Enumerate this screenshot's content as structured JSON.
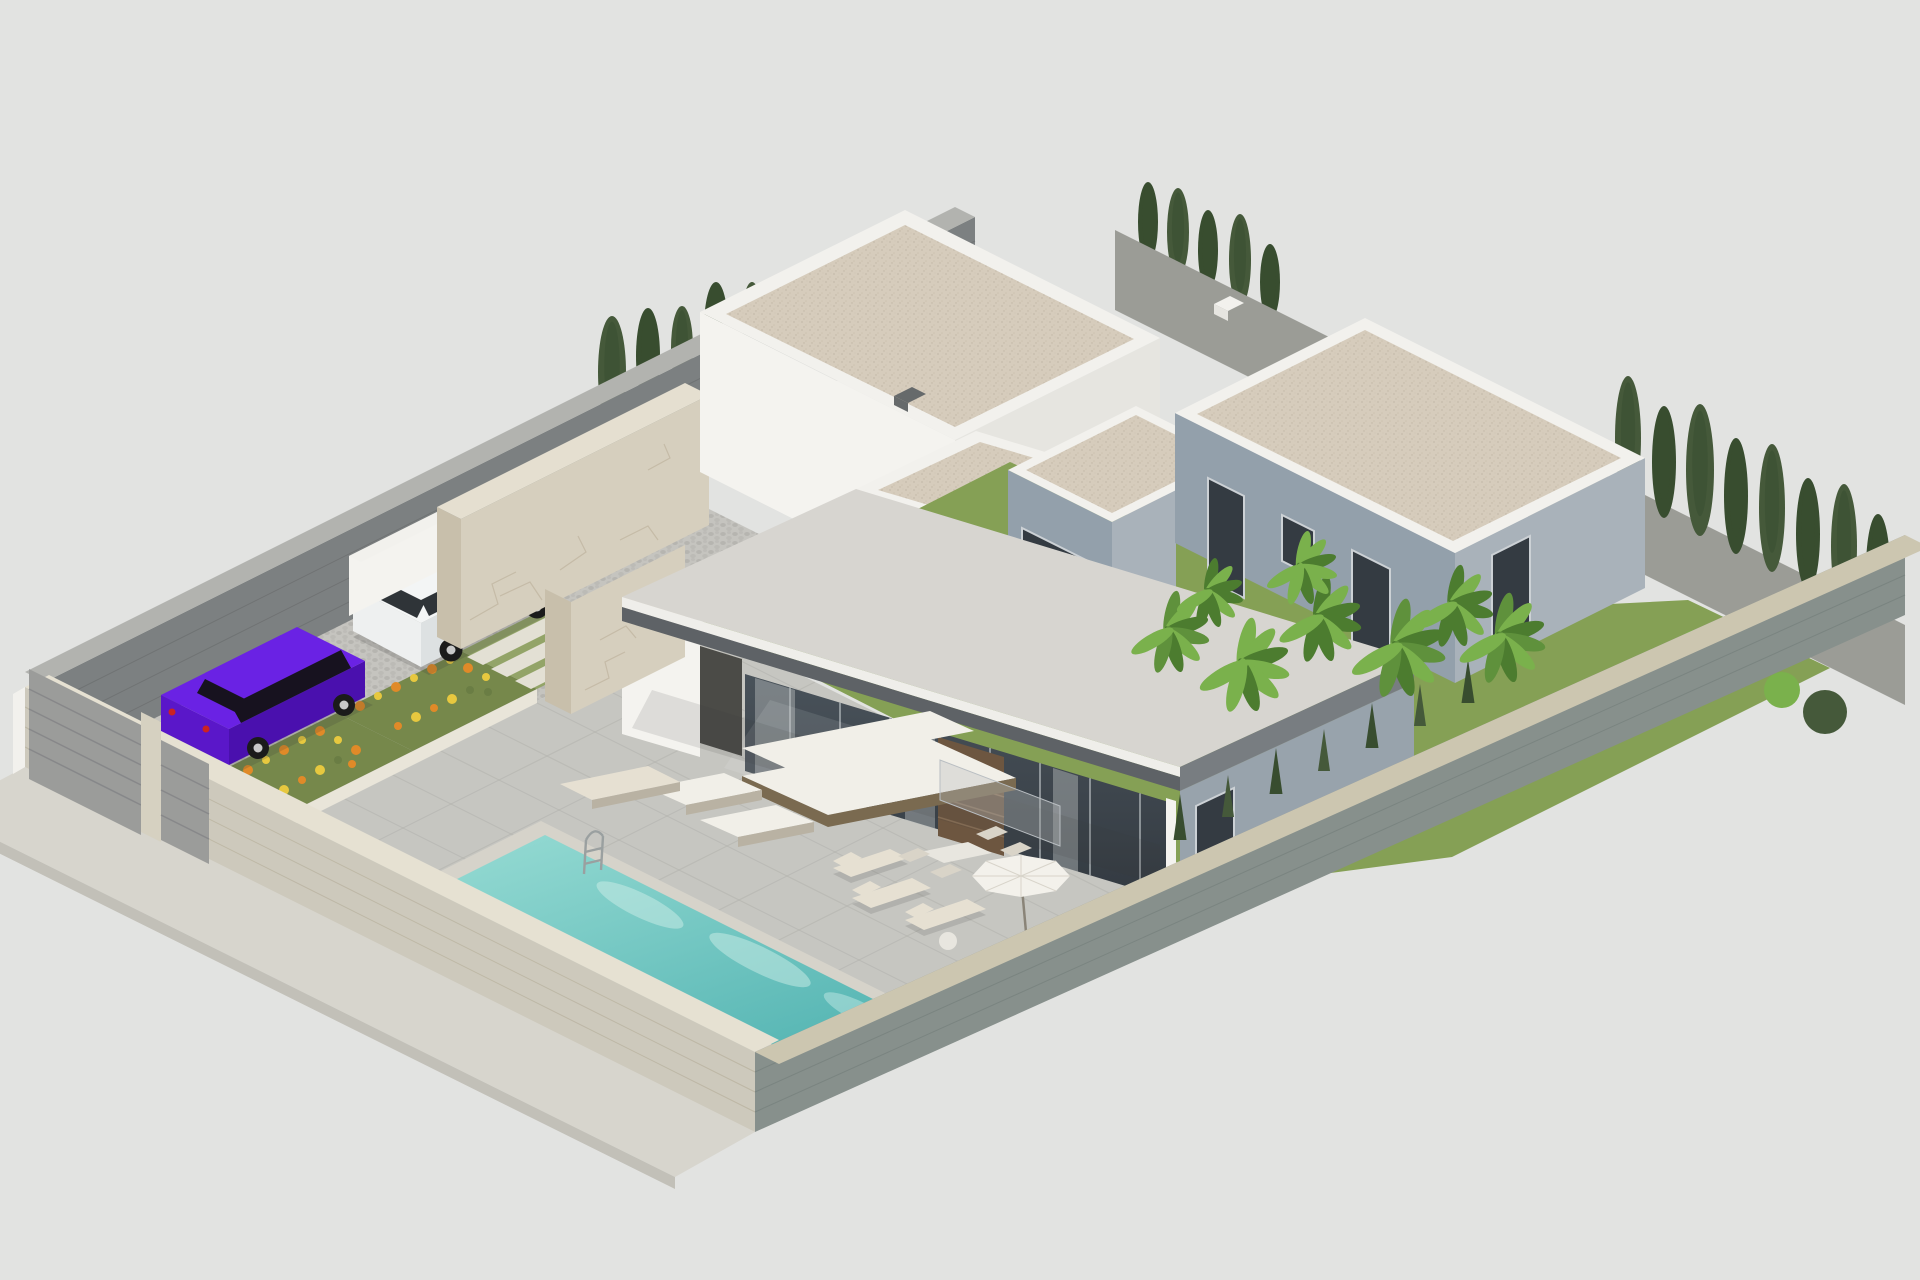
{
  "scene": {
    "description": "Isometric 3D render of a modern flat-roof villa plot: walled parcel with driveway gates, two parked cars, stone feature walls, covered terrace with furniture, swimming pool, gravel roofs, neighbouring grey villa and tropical garden",
    "background": "#e2e3e1",
    "objects": [
      {
        "name": "sidewalk",
        "label": "pavement outside plot"
      },
      {
        "name": "front-wall",
        "label": "front boundary wall"
      },
      {
        "name": "driveway-gate",
        "label": "grey sliding gate"
      },
      {
        "name": "pedestrian-gate",
        "label": "small grey gate"
      },
      {
        "name": "back-wall",
        "label": "rear-left boundary wall"
      },
      {
        "name": "right-wall",
        "label": "right boundary wall"
      },
      {
        "name": "se-wall",
        "label": "lower-right boundary wall"
      },
      {
        "name": "driveway",
        "label": "cobbled carport"
      },
      {
        "name": "purple-sedan",
        "label": "purple car"
      },
      {
        "name": "white-suv",
        "label": "white SUV"
      },
      {
        "name": "flower-planters",
        "label": "planters with orange flowers"
      },
      {
        "name": "garden-steps",
        "label": "grass steps"
      },
      {
        "name": "terrace",
        "label": "paved pool terrace"
      },
      {
        "name": "swimming-pool",
        "label": "turquoise pool with ladder"
      },
      {
        "name": "stone-walls",
        "label": "travertine clad feature walls"
      },
      {
        "name": "rear-annex",
        "label": "rear white building"
      },
      {
        "name": "main-villa",
        "label": "main villa with cantilever roof and glass facade"
      },
      {
        "name": "neighbor-villa",
        "label": "grey neighbouring villa"
      },
      {
        "name": "outdoor-sofa",
        "label": "white outdoor sofa set"
      },
      {
        "name": "sun-loungers",
        "label": "three sun loungers"
      },
      {
        "name": "parasol",
        "label": "white parasol"
      },
      {
        "name": "dining-set",
        "label": "outdoor dining table"
      },
      {
        "name": "banana-plants",
        "label": "tropical plants"
      },
      {
        "name": "cypress-trees",
        "label": "cypress rows"
      },
      {
        "name": "lawn",
        "label": "garden grass"
      }
    ],
    "palette": {
      "bg": "#e2e3e1",
      "sidewalk": "#d7d5cd",
      "sidewalkEdge": "#c2c0b8",
      "frontWall": "#cdc9bc",
      "frontWallLine": "#bdb7a5",
      "frontWallTop": "#e6e1d2",
      "backWall": "#7c8081",
      "backWallLine": "#6f7273",
      "backWallTop": "#b2b3af",
      "rightWall": "#9b9c96",
      "rightWallTop": "#c0bfb6",
      "seWall": "#87908c",
      "seWallLine": "#7a8480",
      "seWallTop": "#ccc6b0",
      "cobble": "url(#cobblePat)",
      "gravel": "url(#gravelPat)",
      "water": "url(#waterGrad)",
      "glass": "url(#glassGrad)",
      "terrace": "#c6c6c1",
      "terraceLine": "#b2b2ad",
      "poolCoping": "#d6d3ca",
      "caustic": "#cdeee8",
      "ladder": "#9aa0a0",
      "planterFace": "#e9e5d9",
      "planterFaceShade": "#d9d4c6",
      "planterSoil": "#76884b",
      "flowerOrange": "#e08a28",
      "flowerYellow": "#e7c83f",
      "flowerGreen": "#6a7d44",
      "stepGrass": "#93a468",
      "stepStone": "#e3e0d4",
      "stone": "#d6cfbe",
      "stoneShade": "#c8bfab",
      "stoneTop": "#e5dfd0",
      "stoneCrack": "#bdb29c",
      "doorDark": "#4b4b47",
      "ventDark": "#666a6b",
      "whiteBright": "#f4f3ef",
      "whiteShade": "#e6e5e0",
      "parapet": "#f2f1ed",
      "slabTop": "#d7d5d0",
      "slabRim": "#efeeea",
      "facia": "#5e6266",
      "faciaEdge": "#787d81",
      "mullion": "#b9bec2",
      "curtain": "#b9bcbd",
      "reflect": "#ffffff",
      "wood": "#6d5640",
      "woodLine": "#8b7157",
      "endWall": "#98a3ac",
      "bWall": "#93a0ab",
      "bWallLight": "#a9b2ba",
      "windowDark": "#343b42",
      "windowFrame": "#ccd1d5",
      "grass": "#85a055",
      "leafA": "#5f913c",
      "leafB": "#7ab14c",
      "leafC": "#4c7c2f",
      "cypressA": "#45593a",
      "cypressB": "#384d2f",
      "trunk": "#5d5a40",
      "purpleTop": "#6a22e4",
      "purpleSide": "#4a10ae",
      "purpleFront": "#5a17c9",
      "purpleGlass": "#17121f",
      "suvTop": "#f3f5f5",
      "suvSide": "#dde1e2",
      "suvFront": "#eef0f0",
      "suvGlass": "#2f3438",
      "wheel": "#1b1b1b",
      "hub": "#c9c9c9",
      "tailLight": "#cc2222",
      "gate": "#9b9c9a",
      "gateLine": "#87888a",
      "gatePost": "#d6d1c1",
      "sofaWhite": "#f1efe8",
      "sofaFrame": "#7a6a50",
      "loungerPad": "#e6e0d2",
      "loungerLeg": "#b9b2a3",
      "tableTop": "#e8e6df",
      "chair": "#d9d4c8",
      "umbrella": "#f3f1eb",
      "umbrellaSeam": "#d8d4ca",
      "pole": "#8a8478",
      "shadow": "#3a3a3a"
    }
  },
  "vegetation": {
    "back_cypresses": [
      {
        "cx": 612,
        "cy": 428,
        "rx": 14,
        "ry": 56,
        "c": "cypressA"
      },
      {
        "cx": 648,
        "cy": 404,
        "rx": 12,
        "ry": 48,
        "c": "cypressB"
      },
      {
        "cx": 682,
        "cy": 390,
        "rx": 11,
        "ry": 42,
        "c": "cypressA"
      },
      {
        "cx": 716,
        "cy": 374,
        "rx": 12,
        "ry": 46,
        "c": "cypressB"
      },
      {
        "cx": 752,
        "cy": 358,
        "rx": 10,
        "ry": 38,
        "c": "cypressA"
      }
    ],
    "ridge_cypresses": [
      {
        "cx": 1148,
        "cy": 262,
        "rx": 10,
        "ry": 40,
        "c": "cypressB"
      },
      {
        "cx": 1178,
        "cy": 276,
        "rx": 11,
        "ry": 44,
        "c": "cypressA"
      },
      {
        "cx": 1208,
        "cy": 290,
        "rx": 10,
        "ry": 40,
        "c": "cypressB"
      },
      {
        "cx": 1240,
        "cy": 306,
        "rx": 11,
        "ry": 46,
        "c": "cypressA"
      },
      {
        "cx": 1270,
        "cy": 320,
        "rx": 10,
        "ry": 38,
        "c": "cypressB"
      }
    ],
    "right_cypresses": [
      {
        "cx": 1628,
        "cy": 500,
        "rx": 13,
        "ry": 62,
        "c": "cypressA"
      },
      {
        "cx": 1664,
        "cy": 518,
        "rx": 12,
        "ry": 56,
        "c": "cypressB"
      },
      {
        "cx": 1700,
        "cy": 536,
        "rx": 14,
        "ry": 66,
        "c": "cypressA"
      },
      {
        "cx": 1736,
        "cy": 554,
        "rx": 12,
        "ry": 58,
        "c": "cypressB"
      },
      {
        "cx": 1772,
        "cy": 572,
        "rx": 13,
        "ry": 64,
        "c": "cypressA"
      },
      {
        "cx": 1808,
        "cy": 590,
        "rx": 12,
        "ry": 56,
        "c": "cypressB"
      },
      {
        "cx": 1844,
        "cy": 608,
        "rx": 13,
        "ry": 62,
        "c": "cypressA"
      },
      {
        "cx": 1878,
        "cy": 624,
        "rx": 12,
        "ry": 55,
        "c": "cypressB"
      }
    ],
    "se_cypresses": [
      {
        "cx": 1180,
        "cy": 840,
        "w": 13,
        "h": 46,
        "c": "cypressB"
      },
      {
        "cx": 1228,
        "cy": 817,
        "w": 12,
        "h": 42,
        "c": "cypressA"
      },
      {
        "cx": 1276,
        "cy": 794,
        "w": 13,
        "h": 46,
        "c": "cypressB"
      },
      {
        "cx": 1324,
        "cy": 771,
        "w": 12,
        "h": 42,
        "c": "cypressA"
      },
      {
        "cx": 1372,
        "cy": 748,
        "w": 13,
        "h": 45,
        "c": "cypressB"
      },
      {
        "cx": 1420,
        "cy": 726,
        "w": 12,
        "h": 42,
        "c": "cypressA"
      },
      {
        "cx": 1468,
        "cy": 703,
        "w": 13,
        "h": 44,
        "c": "cypressB"
      }
    ],
    "bushes": [
      {
        "cx": 1695,
        "cy": 646,
        "r": 16,
        "c": "leafB"
      },
      {
        "cx": 1738,
        "cy": 668,
        "r": 20,
        "c": "cypressA"
      },
      {
        "cx": 1782,
        "cy": 690,
        "r": 18,
        "c": "leafB"
      },
      {
        "cx": 1825,
        "cy": 712,
        "r": 22,
        "c": "cypressA"
      }
    ],
    "banana_plants": [
      {
        "cx": 1168,
        "cy": 652,
        "s": 1.0,
        "c": "leafA"
      },
      {
        "cx": 1242,
        "cy": 688,
        "s": 1.15,
        "c": "leafB"
      },
      {
        "cx": 1318,
        "cy": 640,
        "s": 1.05,
        "c": "leafC"
      },
      {
        "cx": 1396,
        "cy": 672,
        "s": 1.2,
        "c": "leafA"
      },
      {
        "cx": 1300,
        "cy": 586,
        "s": 0.9,
        "c": "leafB"
      },
      {
        "cx": 1452,
        "cy": 626,
        "s": 1.0,
        "c": "leafC"
      },
      {
        "cx": 1208,
        "cy": 610,
        "s": 0.85,
        "c": "leafC"
      },
      {
        "cx": 1500,
        "cy": 660,
        "s": 1.1,
        "c": "leafA"
      }
    ]
  },
  "windows": {
    "neighbor": [
      {
        "points": "1208,478 1244,496 1244,598 1208,580"
      },
      {
        "points": "1282,515 1314,531 1314,577 1282,561"
      },
      {
        "points": "1352,550 1390,569 1390,663 1352,644"
      },
      {
        "points": "1492,555 1530,536 1530,622 1492,641"
      }
    ],
    "wing_glass": {
      "points": "1022,528 1092,563 1092,673 1022,638"
    },
    "end_wall_window": {
      "points": "1196,806 1234,788 1234,884 1196,902"
    }
  },
  "glass_mullions": [
    790,
    840,
    890,
    940,
    990,
    1040,
    1090,
    1140
  ],
  "terrace_grid": {
    "u": [
      [
        343,
        798,
        873,
        1063
      ],
      [
        391,
        774,
        921,
        1039
      ],
      [
        439,
        750,
        969,
        1015
      ],
      [
        487,
        726,
        1017,
        991
      ],
      [
        535,
        702,
        1065,
        967
      ],
      [
        583,
        678,
        1113,
        943
      ],
      [
        631,
        654,
        1161,
        919
      ],
      [
        679,
        630,
        1209,
        895
      ]
    ],
    "v": [
      [
        315,
        872,
        755,
        652
      ],
      [
        375,
        902,
        815,
        682
      ],
      [
        435,
        932,
        875,
        712
      ],
      [
        495,
        962,
        935,
        742
      ],
      [
        555,
        992,
        995,
        772
      ],
      [
        615,
        1022,
        1055,
        802
      ],
      [
        675,
        1052,
        1115,
        832
      ],
      [
        735,
        1082,
        1175,
        862
      ]
    ]
  },
  "flowers": {
    "bedA": [
      {
        "x": 360,
        "y": 706,
        "r": 5,
        "c": "flowerOrange"
      },
      {
        "x": 378,
        "y": 696,
        "r": 4,
        "c": "flowerYellow"
      },
      {
        "x": 396,
        "y": 687,
        "r": 5,
        "c": "flowerOrange"
      },
      {
        "x": 414,
        "y": 678,
        "r": 4,
        "c": "flowerYellow"
      },
      {
        "x": 432,
        "y": 669,
        "r": 5,
        "c": "flowerOrange"
      },
      {
        "x": 450,
        "y": 660,
        "r": 4,
        "c": "flowerYellow"
      },
      {
        "x": 468,
        "y": 668,
        "r": 5,
        "c": "flowerOrange"
      },
      {
        "x": 486,
        "y": 677,
        "r": 4,
        "c": "flowerYellow"
      },
      {
        "x": 470,
        "y": 690,
        "r": 4,
        "c": "flowerGreen"
      },
      {
        "x": 452,
        "y": 699,
        "r": 5,
        "c": "flowerYellow"
      },
      {
        "x": 434,
        "y": 708,
        "r": 4,
        "c": "flowerOrange"
      },
      {
        "x": 416,
        "y": 717,
        "r": 5,
        "c": "flowerYellow"
      },
      {
        "x": 398,
        "y": 726,
        "r": 4,
        "c": "flowerOrange"
      },
      {
        "x": 488,
        "y": 692,
        "r": 4,
        "c": "flowerGreen"
      }
    ],
    "bedB": [
      {
        "x": 248,
        "y": 770,
        "r": 5,
        "c": "flowerOrange"
      },
      {
        "x": 266,
        "y": 760,
        "r": 4,
        "c": "flowerYellow"
      },
      {
        "x": 284,
        "y": 750,
        "r": 5,
        "c": "flowerOrange"
      },
      {
        "x": 302,
        "y": 740,
        "r": 4,
        "c": "flowerYellow"
      },
      {
        "x": 320,
        "y": 731,
        "r": 5,
        "c": "flowerOrange"
      },
      {
        "x": 338,
        "y": 740,
        "r": 4,
        "c": "flowerYellow"
      },
      {
        "x": 356,
        "y": 750,
        "r": 5,
        "c": "flowerOrange"
      },
      {
        "x": 338,
        "y": 760,
        "r": 4,
        "c": "flowerGreen"
      },
      {
        "x": 320,
        "y": 770,
        "r": 5,
        "c": "flowerYellow"
      },
      {
        "x": 302,
        "y": 780,
        "r": 4,
        "c": "flowerOrange"
      },
      {
        "x": 284,
        "y": 790,
        "r": 5,
        "c": "flowerYellow"
      },
      {
        "x": 352,
        "y": 764,
        "r": 4,
        "c": "flowerOrange"
      }
    ]
  }
}
